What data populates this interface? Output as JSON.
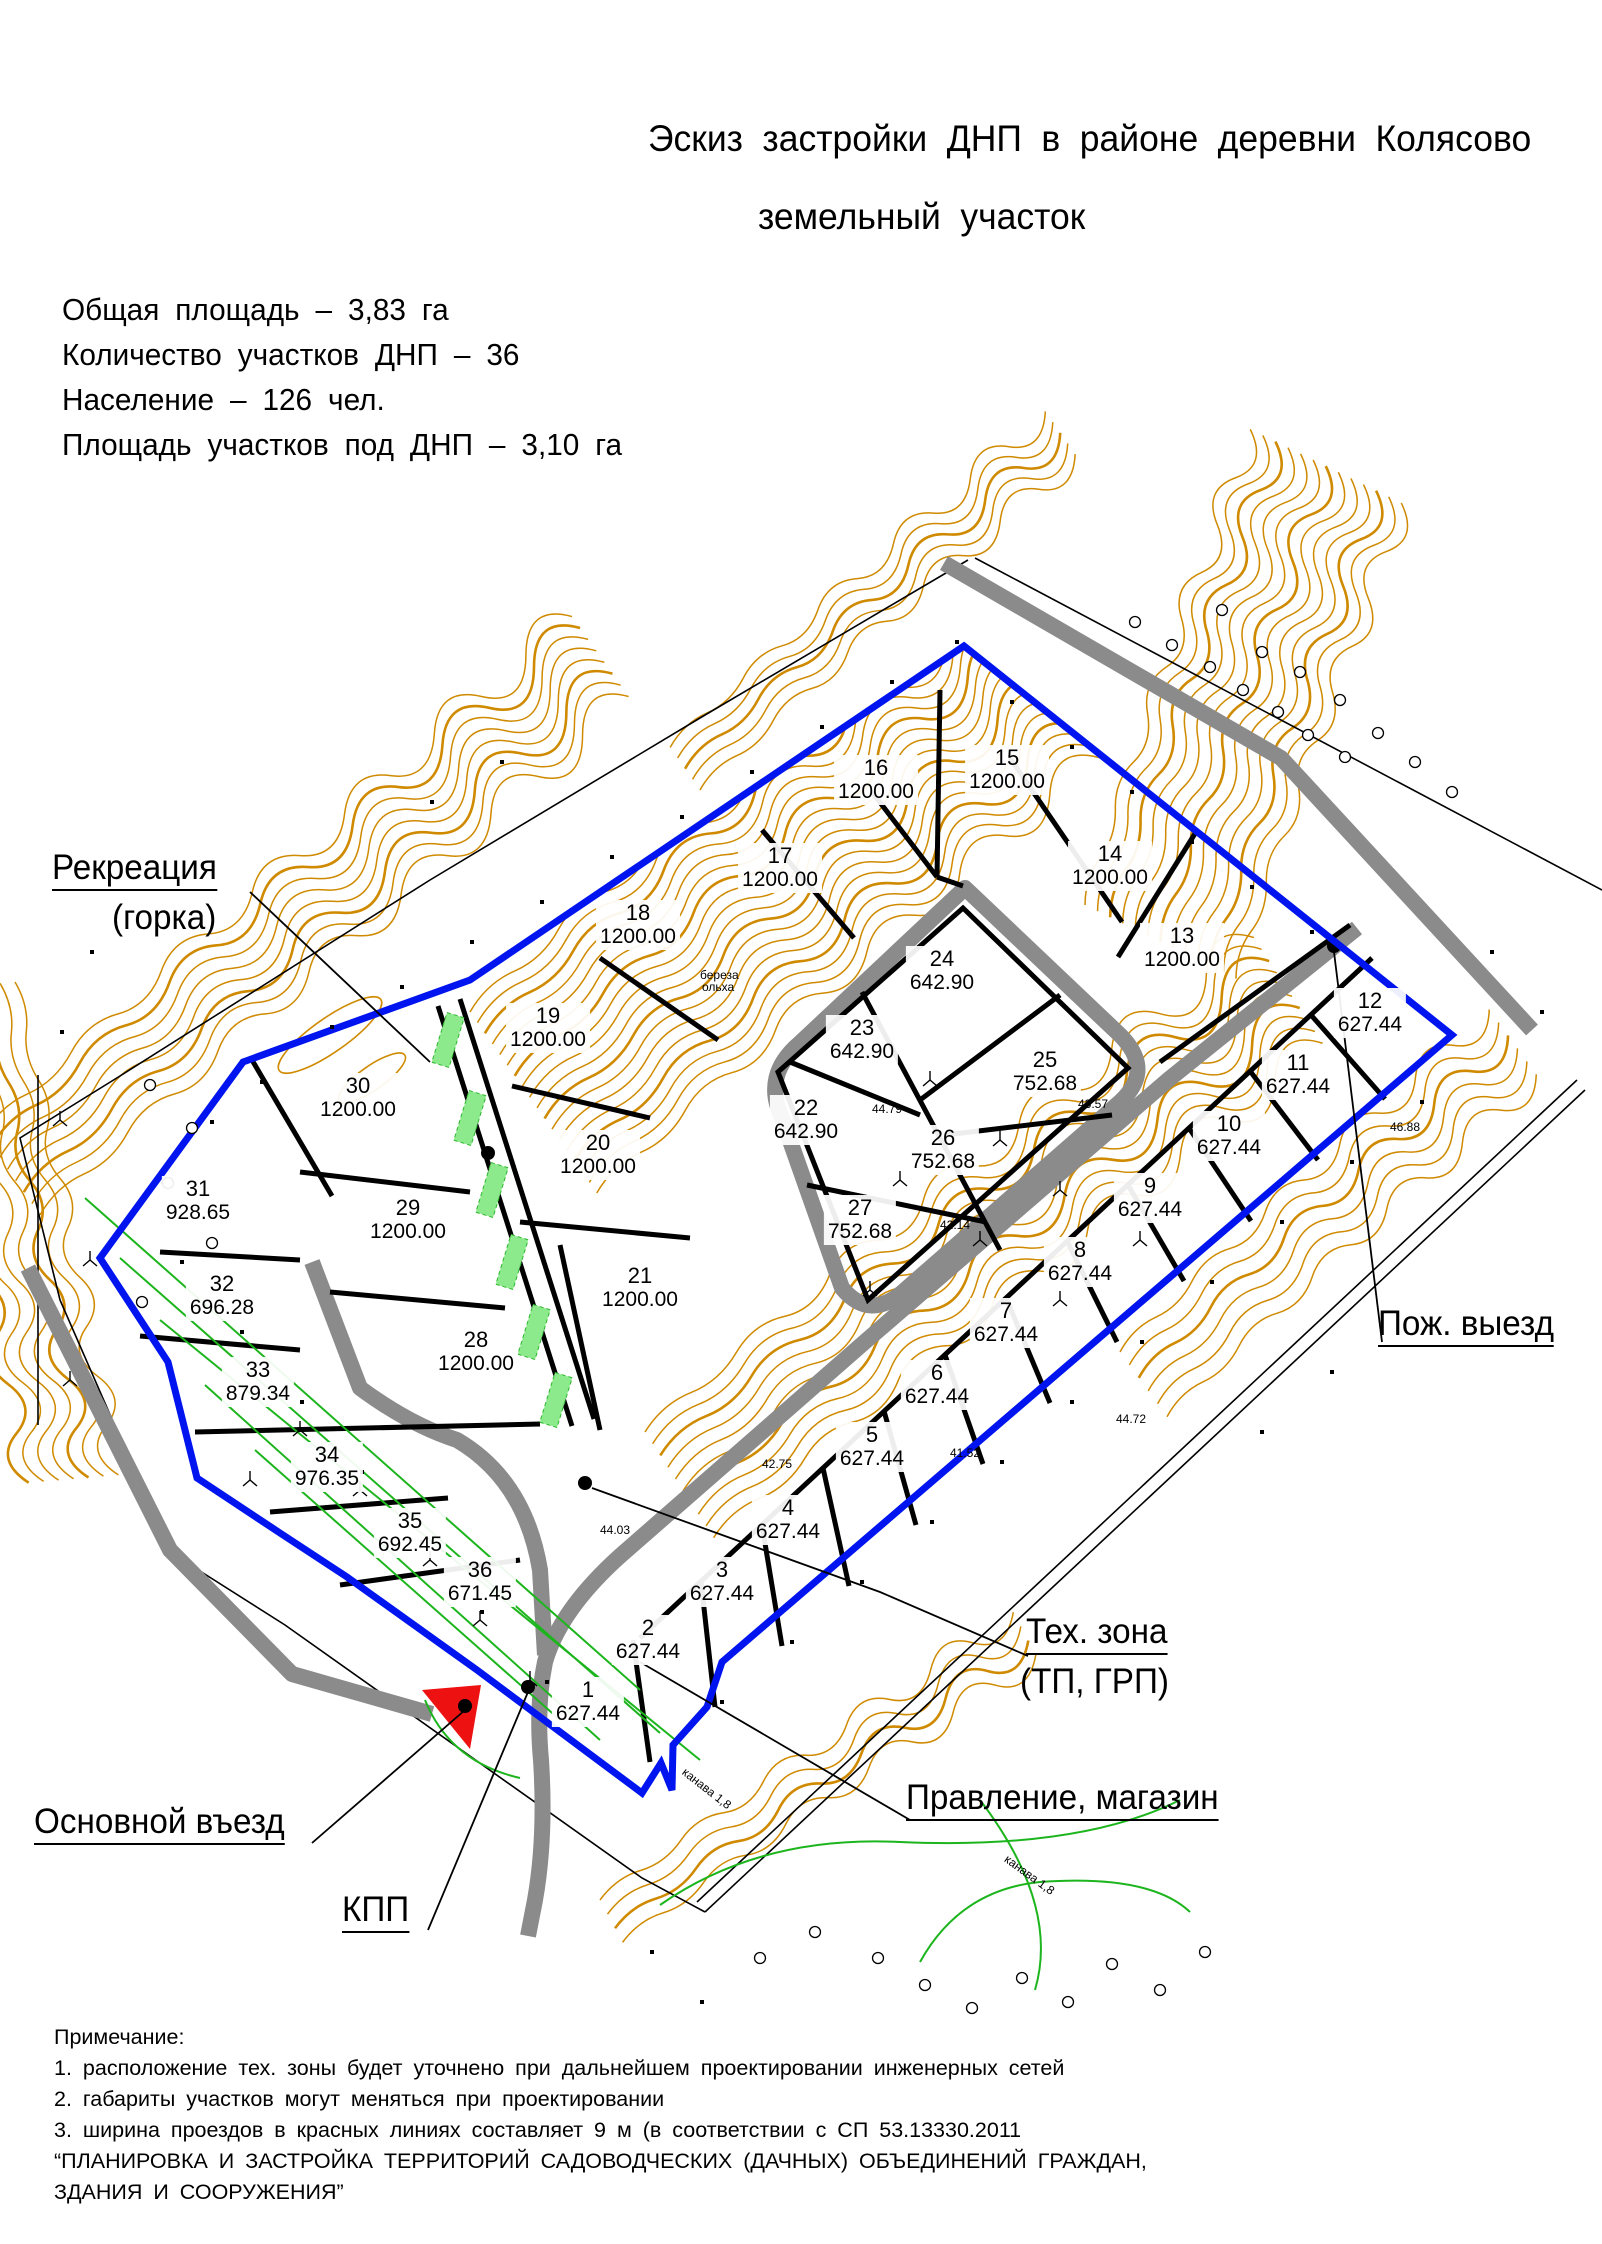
{
  "title": {
    "line1": "Эскиз застройки ДНП в районе деревни Колясово",
    "line2": "земельный участок"
  },
  "summary": {
    "line1": "Общая площадь – 3,83 га",
    "line2": "Количество участков ДНП – 36",
    "line3": "Население – 126 чел.",
    "line4": "Площадь участков под ДНП –  3,10 га"
  },
  "callouts": {
    "recreation_line1": "Рекреация",
    "recreation_line2": "(горка)",
    "fire_exit": "Пож. выезд",
    "tech_zone_line1": "Тех. зона",
    "tech_zone_line2": "(ТП, ГРП)",
    "board_shop": "Правление, магазин",
    "main_entrance": "Основной въезд",
    "checkpoint": "КПП"
  },
  "notes": {
    "heading": "Примечание:",
    "items": [
      "1.  расположение  тех.  зоны  будет  уточнено  при  дальнейшем  проектировании  инженерных  сетей",
      "2.  габариты  участков  могут  меняться  при  проектировании",
      "3.  ширина  проездов  в  красных  линиях  составляет  9 м   (в  соответствии  с  СП 53.13330.2011",
      "“ПЛАНИРОВКА  И  ЗАСТРОЙКА  ТЕРРИТОРИЙ  САДОВОДЧЕСКИХ  (ДАЧНЫХ)  ОБЪЕДИНЕНИЙ  ГРАЖДАН,",
      "ЗДАНИЯ  И  СООРУЖЕНИЯ”"
    ]
  },
  "plots": [
    {
      "n": "1",
      "area": "627.44",
      "x": 588,
      "y": 1702
    },
    {
      "n": "2",
      "area": "627.44",
      "x": 648,
      "y": 1640
    },
    {
      "n": "3",
      "area": "627.44",
      "x": 722,
      "y": 1582
    },
    {
      "n": "4",
      "area": "627.44",
      "x": 788,
      "y": 1520
    },
    {
      "n": "5",
      "area": "627.44",
      "x": 872,
      "y": 1447
    },
    {
      "n": "6",
      "area": "627.44",
      "x": 937,
      "y": 1385
    },
    {
      "n": "7",
      "area": "627.44",
      "x": 1006,
      "y": 1323
    },
    {
      "n": "8",
      "area": "627.44",
      "x": 1080,
      "y": 1262
    },
    {
      "n": "9",
      "area": "627.44",
      "x": 1150,
      "y": 1198
    },
    {
      "n": "10",
      "area": "627.44",
      "x": 1229,
      "y": 1136
    },
    {
      "n": "11",
      "area": "627.44",
      "x": 1298,
      "y": 1075
    },
    {
      "n": "12",
      "area": "627.44",
      "x": 1370,
      "y": 1013
    },
    {
      "n": "13",
      "area": "1200.00",
      "x": 1182,
      "y": 948
    },
    {
      "n": "14",
      "area": "1200.00",
      "x": 1110,
      "y": 866
    },
    {
      "n": "15",
      "area": "1200.00",
      "x": 1007,
      "y": 770
    },
    {
      "n": "16",
      "area": "1200.00",
      "x": 876,
      "y": 780
    },
    {
      "n": "17",
      "area": "1200.00",
      "x": 780,
      "y": 868
    },
    {
      "n": "18",
      "area": "1200.00",
      "x": 638,
      "y": 925
    },
    {
      "n": "19",
      "area": "1200.00",
      "x": 548,
      "y": 1028
    },
    {
      "n": "20",
      "area": "1200.00",
      "x": 598,
      "y": 1155
    },
    {
      "n": "21",
      "area": "1200.00",
      "x": 640,
      "y": 1288
    },
    {
      "n": "22",
      "area": "642.90",
      "x": 806,
      "y": 1120
    },
    {
      "n": "23",
      "area": "642.90",
      "x": 862,
      "y": 1040
    },
    {
      "n": "24",
      "area": "642.90",
      "x": 942,
      "y": 971
    },
    {
      "n": "25",
      "area": "752.68",
      "x": 1045,
      "y": 1072
    },
    {
      "n": "26",
      "area": "752.68",
      "x": 943,
      "y": 1150
    },
    {
      "n": "27",
      "area": "752.68",
      "x": 860,
      "y": 1220
    },
    {
      "n": "28",
      "area": "1200.00",
      "x": 476,
      "y": 1352
    },
    {
      "n": "29",
      "area": "1200.00",
      "x": 408,
      "y": 1220
    },
    {
      "n": "30",
      "area": "1200.00",
      "x": 358,
      "y": 1098
    },
    {
      "n": "31",
      "area": "928.65",
      "x": 198,
      "y": 1201
    },
    {
      "n": "32",
      "area": "696.28",
      "x": 222,
      "y": 1296
    },
    {
      "n": "33",
      "area": "879.34",
      "x": 258,
      "y": 1382
    },
    {
      "n": "34",
      "area": "976.35",
      "x": 327,
      "y": 1467
    },
    {
      "n": "35",
      "area": "692.45",
      "x": 410,
      "y": 1533
    },
    {
      "n": "36",
      "area": "671.45",
      "x": 480,
      "y": 1582
    }
  ],
  "tiny_labels": [
    {
      "text": "береза",
      "x": 700,
      "y": 968,
      "rot": 0
    },
    {
      "text": "ольха",
      "x": 702,
      "y": 980,
      "rot": 0
    },
    {
      "text": "44.79",
      "x": 872,
      "y": 1102,
      "rot": 0
    },
    {
      "text": "43.57",
      "x": 1078,
      "y": 1097,
      "rot": 0
    },
    {
      "text": "42.14",
      "x": 940,
      "y": 1218,
      "rot": 0
    },
    {
      "text": "41.52",
      "x": 950,
      "y": 1446,
      "rot": 0
    },
    {
      "text": "44.03",
      "x": 600,
      "y": 1523,
      "rot": 0
    },
    {
      "text": "42.75",
      "x": 762,
      "y": 1457,
      "rot": 0
    },
    {
      "text": "44.72",
      "x": 1116,
      "y": 1412,
      "rot": 0
    },
    {
      "text": "46.88",
      "x": 1390,
      "y": 1120,
      "rot": 0
    },
    {
      "text": "канава 1,8",
      "x": 688,
      "y": 1765,
      "rot": 38
    },
    {
      "text": "канава 1,8",
      "x": 1010,
      "y": 1852,
      "rot": 36
    }
  ],
  "colors": {
    "boundary_blue": "#0014f0",
    "road_gray": "#8b8b8b",
    "contour_orange": "#cf8a00",
    "vegetation_green": "#1db51d",
    "strip_green": "#8cea8c",
    "entrance_red": "#ee1111",
    "line_black": "#000000"
  }
}
